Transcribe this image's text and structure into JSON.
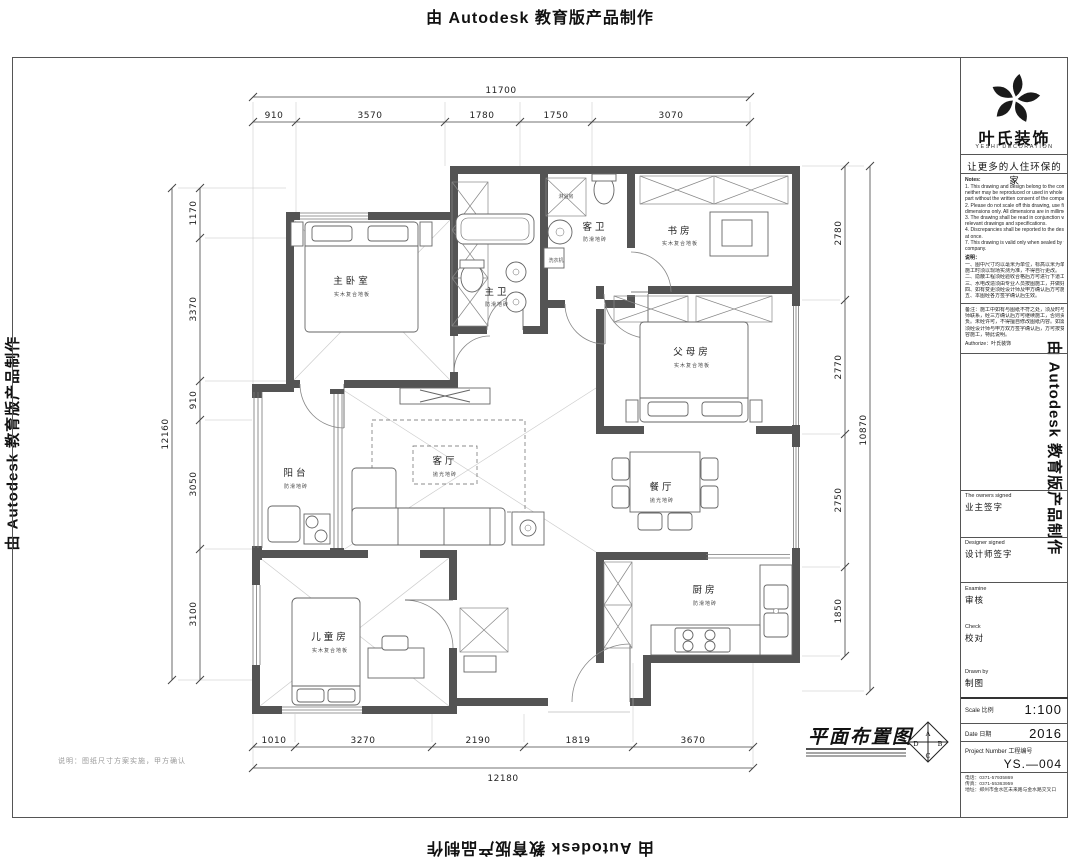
{
  "watermark": {
    "text": "由 Autodesk 教育版产品制作"
  },
  "title_block": {
    "company_cn": "叶氏装饰",
    "company_en": "YESHI DECORATION",
    "slogan": "让更多的人住环保的家",
    "notes_en_title": "Notes:",
    "notes_en": [
      "1. This drawing and design belong to the company",
      "neither may be reproduced or used in whole or in",
      "part without the written consent of the company.",
      "2. Please do not scale off this drawing, use figured",
      "dimensions only. All dimensions are in millimeter.",
      "3. The drawing shall be read in conjunction with all",
      "relevant drawings and specifications.",
      "4. Discrepancies shall be reported to the designer",
      "at once.",
      "7. This drawing is valid only when sealed by the",
      "company."
    ],
    "notes_cn_title": "说明：",
    "notes_cn": [
      "一、图中尺寸均以毫米为单位，标高以米为单位，",
      "施工时须以现场实测为准，不得自行更改。",
      "二、隐蔽工程须经验收合格后方可进行下道工序。",
      "三、水电改造须由专业人员按图施工，并做好记录。",
      "四、如有变更须经设计师及甲方确认后方可施工。",
      "五、本图经各方签字确认后生效。"
    ],
    "remark": [
      "备注：施工中如有与图纸不符之处，须及时与设计",
      "师联系，经三方确认后方可继续施工，否则责任自",
      "负。未经许可，不得擅自修改图纸内容。如需变更，",
      "须经设计师与甲方双方签字确认后，方可按变更内",
      "容施工，特此说明。"
    ],
    "authorize": "Authorize：叶氏装饰",
    "owners_signed_en": "The owners signed",
    "owners_signed_cn": "业主签字",
    "designer_signed_en": "Designer signed",
    "designer_signed_cn": "设计师签字",
    "examine_en": "Examine",
    "examine_cn": "审核",
    "check_en": "Check",
    "check_cn": "校对",
    "drawn_by_en": "Drawn by",
    "drawn_by_cn": "制图",
    "scale_label": "Scale 比例",
    "scale_value": "1:100",
    "date_label": "Date 日期",
    "date_value": "2016",
    "project_label": "Project Number 工程编号",
    "project_value": "YS.—004",
    "contact": [
      "电话：0371-57935869",
      "传真：0371-55363959",
      "地址：郑州市金水区未来路与金水路交叉口"
    ]
  },
  "dimensions": {
    "top": {
      "overall": "11700",
      "segments": [
        "910",
        "3570",
        "1780",
        "1750",
        "3070"
      ]
    },
    "left": {
      "overall": "12160",
      "segments": [
        "1170",
        "3370",
        "910",
        "3050",
        "3100"
      ]
    },
    "right": {
      "overall": "10870",
      "segments": [
        "2780",
        "2770",
        "2750",
        "1850"
      ]
    },
    "bottom": {
      "overall": "12180",
      "segments": [
        "1010",
        "3270",
        "2190",
        "1819",
        "3670"
      ]
    }
  },
  "rooms": [
    {
      "name": "主卧室",
      "finish": "实木复合地板"
    },
    {
      "name": "主卫",
      "finish": "防滑地砖"
    },
    {
      "name": "客卫",
      "finish": "防滑地砖"
    },
    {
      "name": "书房",
      "finish": "实木复合地板"
    },
    {
      "name": "父母房",
      "finish": "实木复合地板"
    },
    {
      "name": "阳台",
      "finish": "防滑地砖"
    },
    {
      "name": "客厅",
      "finish": "抛光地砖"
    },
    {
      "name": "餐厅",
      "finish": "抛光地砖"
    },
    {
      "name": "厨房",
      "finish": "防滑地砖"
    },
    {
      "name": "儿童房",
      "finish": "实木复合地板"
    }
  ],
  "fixture_labels": {
    "shower": "淋浴房",
    "washer": "洗衣机"
  },
  "plan_title": {
    "label": "平面布置图",
    "compass_a": "A",
    "compass_b": "B",
    "compass_c": "C",
    "compass_d": "D"
  },
  "footer_note": "说明：图纸尺寸方案实施，甲方确认"
}
